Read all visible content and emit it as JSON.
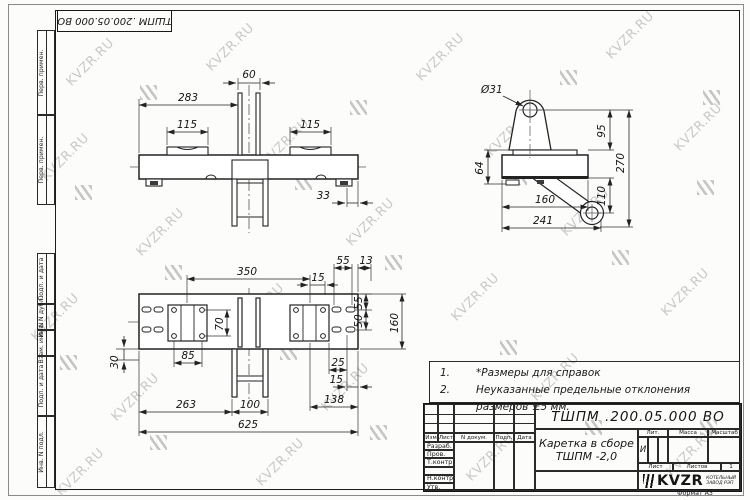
{
  "watermark": {
    "text": "KVZR.RU"
  },
  "stamp": {
    "doc_number": "ТШПМ .200.05.000  ВО"
  },
  "margin": {
    "box1": "Перв. примен.",
    "box2": "Перв. примен.",
    "box3": "Подп. и дата",
    "box4": "Инв. N дубл.",
    "box5": "Взам. инв. N",
    "box6": "Подп. и дата",
    "box7": "Инв. N подл."
  },
  "dims": {
    "front": {
      "w60": "60",
      "w283": "283",
      "w115l": "115",
      "w115r": "115",
      "w33": "33"
    },
    "side": {
      "dia": "Ø31",
      "h95": "95",
      "h270": "270",
      "h110": "110",
      "h64": "64",
      "w160": "160",
      "w241": "241"
    },
    "plan": {
      "w350": "350",
      "w15t": "15",
      "w55t": "55",
      "w13": "13",
      "h55": "55",
      "h50": "50",
      "h160": "160",
      "h70": "70",
      "w85": "85",
      "h30": "30",
      "w25": "25",
      "w15b": "15",
      "w263": "263",
      "w100": "100",
      "w138": "138",
      "w625": "625"
    }
  },
  "notes": {
    "n1_num": "1.",
    "n1_text": "*Размеры для справок",
    "n2_num": "2.",
    "n2_text": "Неуказанные предельные отклонения размеров  ±5 мм."
  },
  "title_block": {
    "doc_number": "ТШПМ .200.05.000  ВО",
    "name_line1": "Каретка в сборе",
    "name_line2": "ТШПМ -2,0",
    "col_izm": "Изм",
    "col_list": "Лист",
    "col_docum": "N докум.",
    "col_podp": "Подп.",
    "col_data": "Дата",
    "row_razrab": "Разраб.",
    "row_prov": "Пров.",
    "row_tkontr": "Т.контр.",
    "row_nkontr": "Н.контр.",
    "row_utv": "Утв.",
    "lit_label": "Лит.",
    "lit_value": "И",
    "massa_label": "Масса",
    "masshtab_label": "Масштаб",
    "list_label": "Лист",
    "listov_label": "Листов",
    "listov_value": "1",
    "logo_text": "KVZR",
    "logo_sub1": "КОТЕЛЬНЫЙ",
    "logo_sub2": "ЗАВОД РЭП",
    "format_label": "Формат А3"
  }
}
